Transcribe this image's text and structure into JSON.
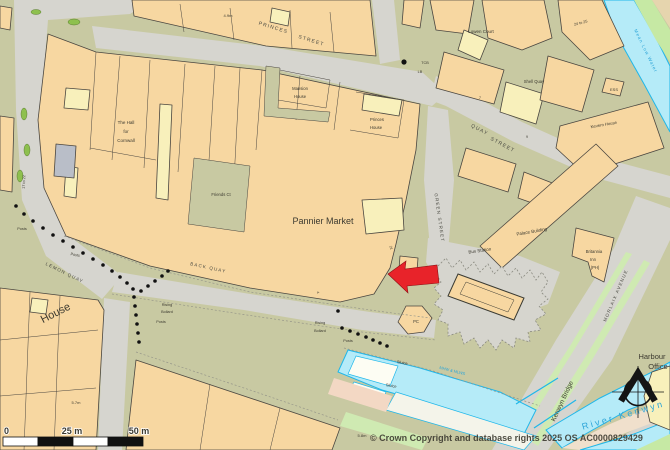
{
  "colors": {
    "building": "#f7d7a1",
    "highlight_building": "#f8f0bb",
    "road": "#d6d5cf",
    "pedestrian": "#c8c9a2",
    "water_fill": "#b5ebf8",
    "water_stroke": "#1fb7ea",
    "grass": "#c6e9a4",
    "arrow_red": "#e8232a",
    "outline": "#4a4640"
  },
  "labels": {
    "streets": {
      "princes_1": "PRINCES",
      "princes_2": "STREET",
      "quay_1": "QUAY",
      "quay_2": "STREET",
      "green_street": "GREEN STREET",
      "lemon_quay": "LEMON QUAY",
      "back_quay": "BACK QUAY",
      "morlaix_avenue": "MORLAIX AVENUE",
      "kenwyn_bridge": "Kenwyn Bridge"
    },
    "water": {
      "river_kenwyn": "River Kenwyn",
      "mean_low_water": "Mean Low Water",
      "mhw_mlws": "MHW & MLWS",
      "sluice": "Sluice"
    },
    "buildings": {
      "pannier_market": "Pannier Market",
      "hall_line1": "The Hall",
      "hall_line2": "for",
      "hall_line3": "Cornwall",
      "mansion_line1": "Mansion",
      "mansion_line2": "House",
      "princes_house_line1": "Princes",
      "princes_house_line2": "House",
      "friends_ct": "Friends Ct",
      "lowen_court": "Lowen Court",
      "shell_quay": "Shell Quay",
      "kevern_house": "Kevern House",
      "palace_building": "Palace Building",
      "bus_station": "Bus Station",
      "britannia_line1": "Britannia",
      "britannia_line2": "Inn",
      "britannia_line3": "(PH)",
      "harbour_line1": "Harbour",
      "harbour_line2": "Office",
      "house": "House"
    },
    "features": {
      "pc": "PC",
      "tcb": "TCB",
      "lb": "LB",
      "ess": "ESS",
      "posts": "Posts",
      "rising": "Rising",
      "bollard": "Bollard",
      "range_17_22": "17 to 22",
      "range_24_25": "24 to 25",
      "n4": "4",
      "n7": "7",
      "n9": "9",
      "n21": "21"
    },
    "spot_heights": {
      "h_49": "4.9m",
      "h_57": "5.7m",
      "h_58": "5.8m"
    }
  },
  "scale_bar": {
    "zero": "0",
    "mid": "25 m",
    "end": "50 m"
  },
  "copyright": "© Crown Copyright and database rights 2025 OS AC0000829429"
}
